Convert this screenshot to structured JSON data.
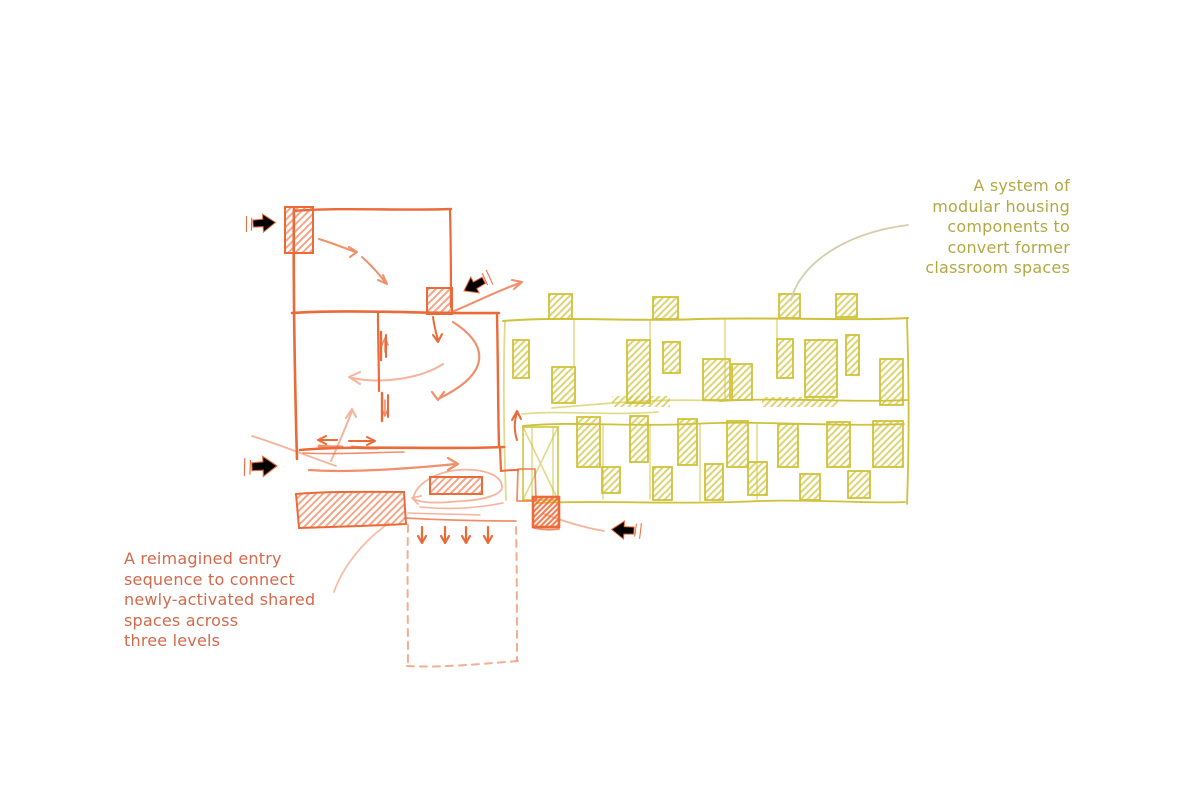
{
  "annotations": {
    "left": {
      "lines": [
        "A reimagined entry",
        "sequence to connect",
        "newly-activated shared",
        "spaces across",
        "three levels"
      ]
    },
    "right": {
      "lines": [
        "A system of",
        "modular housing",
        "components to",
        "convert former",
        "classroom spaces"
      ]
    }
  },
  "theme": {
    "background": "#ffffff",
    "orange_ink": "#ec6a38",
    "orange_text": "#d4694b",
    "olive_ink": "#cfc23a",
    "olive_text": "#b2a944",
    "connector": "#d5cdab"
  }
}
